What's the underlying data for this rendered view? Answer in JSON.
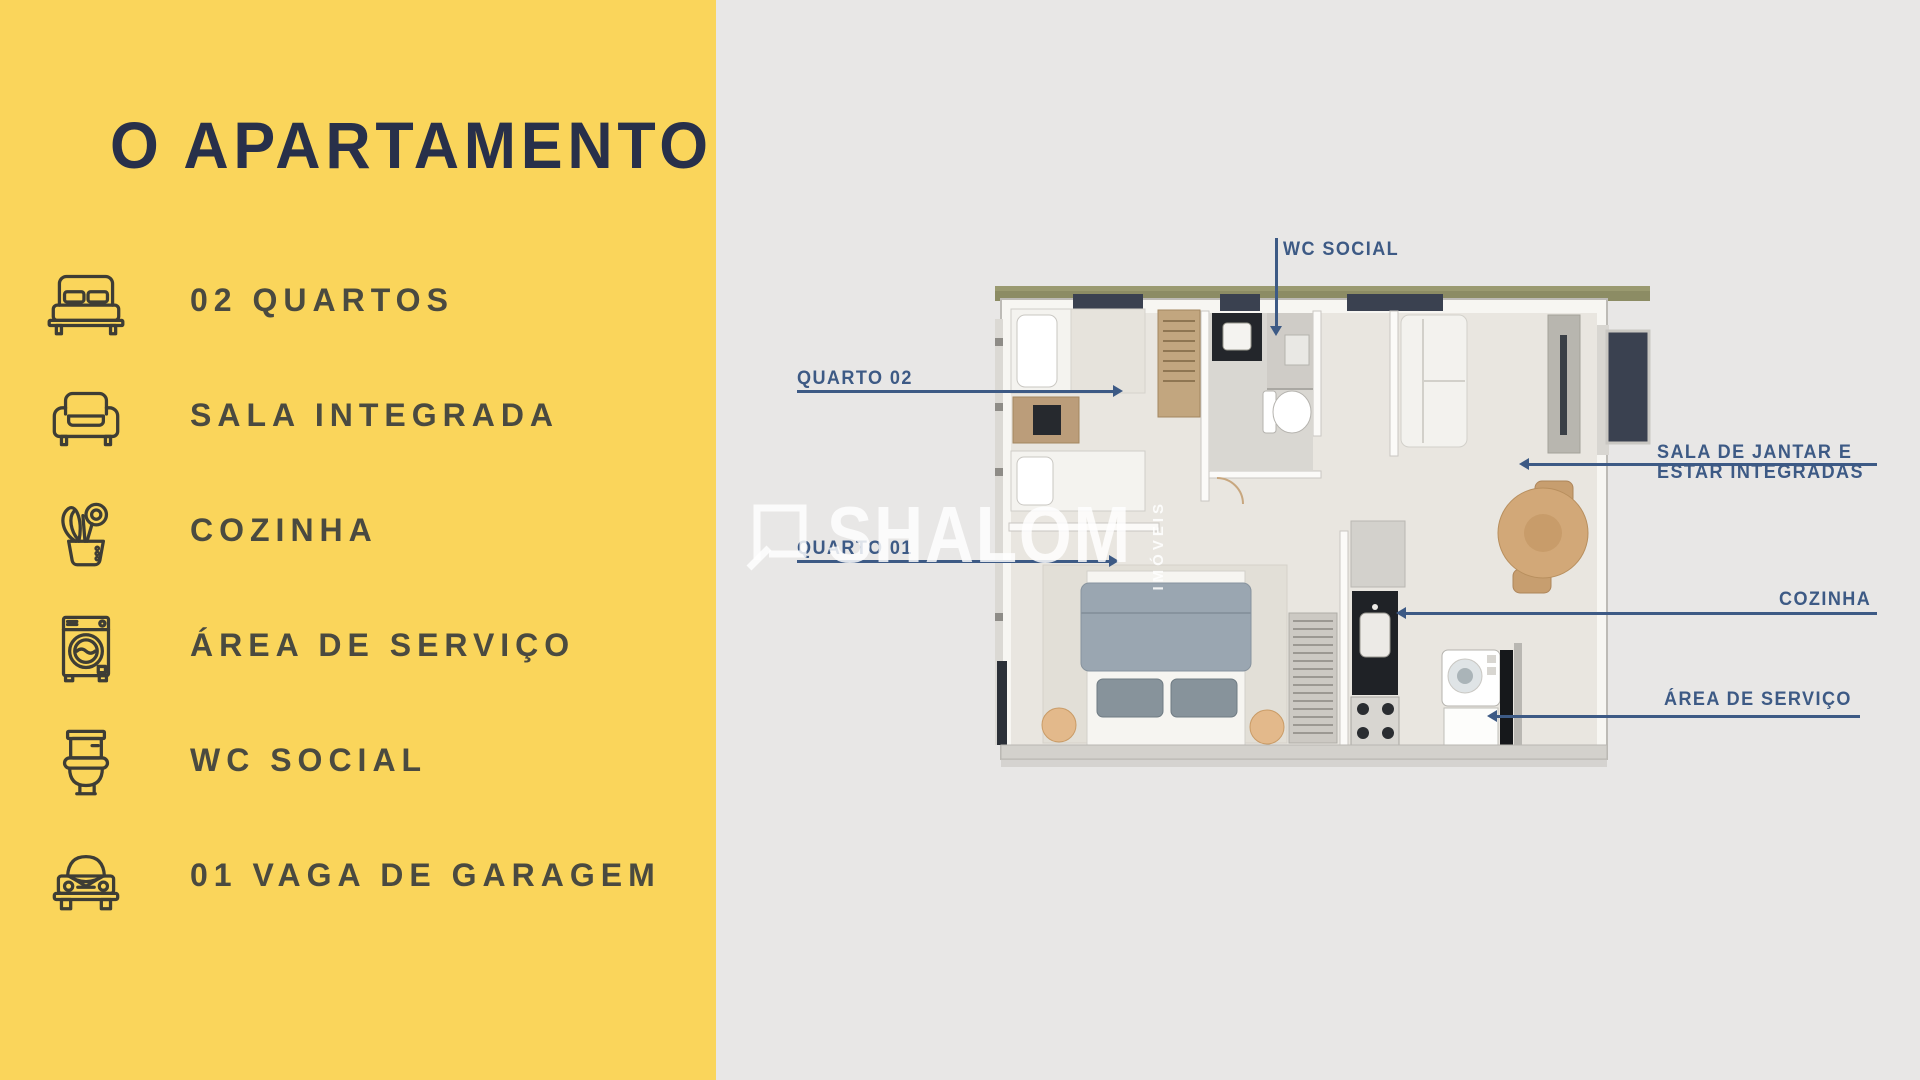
{
  "panel": {
    "title": "O APARTAMENTO",
    "features": [
      {
        "icon": "bed-icon",
        "label": "02 QUARTOS"
      },
      {
        "icon": "sofa-icon",
        "label": "SALA INTEGRADA"
      },
      {
        "icon": "utensils-icon",
        "label": "COZINHA"
      },
      {
        "icon": "washer-icon",
        "label": "ÁREA DE SERVIÇO"
      },
      {
        "icon": "toilet-icon",
        "label": "WC SOCIAL"
      },
      {
        "icon": "car-icon",
        "label": "01 VAGA DE GARAGEM"
      }
    ]
  },
  "plan": {
    "labels": {
      "wc": "WC SOCIAL",
      "quarto02": "QUARTO 02",
      "quarto01": "QUARTO 01",
      "sala_line1": "SALA DE JANTAR E",
      "sala_line2": "ESTAR INTEGRADAS",
      "cozinha": "COZINHA",
      "area_servico": "ÁREA DE SERVIÇO"
    }
  },
  "watermark": {
    "brand": "SHALOM",
    "sub": "IMÓVEIS"
  },
  "colors": {
    "sidebar_yellow": "#FAD55B",
    "canvas_gray": "#E8E7E6",
    "label_blue": "#3D5A85",
    "title_navy": "#28304A",
    "sidebar_text": "#4A4A40",
    "icon_stroke": "#3E3D35",
    "grass_green": "#8C8C64"
  }
}
